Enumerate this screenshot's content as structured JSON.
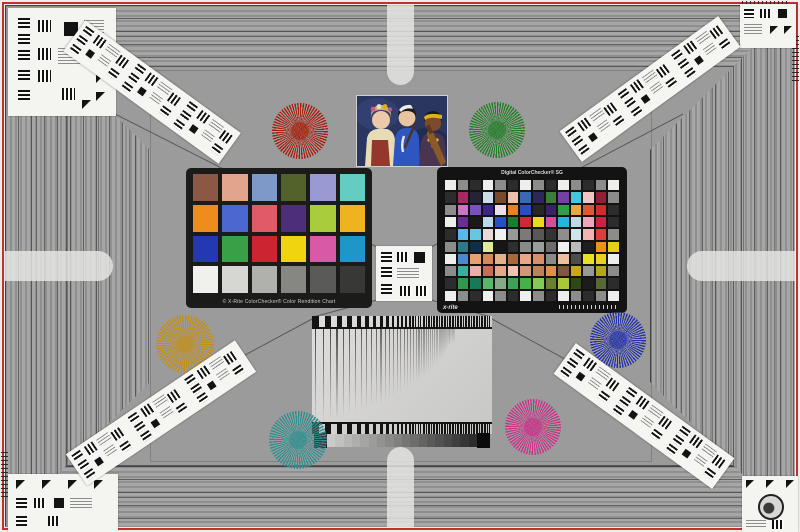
{
  "scene": {
    "base_gray": "#9b9b9b",
    "border_red": "#c23030",
    "edge_white": "#ededea",
    "pill_color": "rgba(230,230,228,0.82)",
    "diag_line": "#5a5a5a"
  },
  "colorchecker24": {
    "label": "© X-Rite ColorChecker® Color Rendition Chart",
    "frame": "#1b1b19",
    "rows": [
      [
        "#8a5843",
        "#e2a58c",
        "#7e99c8",
        "#52622a",
        "#9a9ad2",
        "#64ccc0"
      ],
      [
        "#ef8c1e",
        "#4a68d0",
        "#e05a68",
        "#4c2e7a",
        "#a8cc3c",
        "#eeb31e"
      ],
      [
        "#2438b4",
        "#3aa048",
        "#cc2430",
        "#f0d410",
        "#d85aa6",
        "#1e96c8"
      ],
      [
        "#f0f0ec",
        "#d6d6d2",
        "#b0b0ac",
        "#868682",
        "#5a5a58",
        "#383836"
      ]
    ]
  },
  "colorchecker_sg": {
    "title": "Digital ColorChecker® SG",
    "brand": "x-rite",
    "frame": "#131313",
    "grid": [
      [
        "#eeeeec",
        "#8c8c8a",
        "#2c2c2c",
        "#eeeeec",
        "#8c8c8a",
        "#2c2c2c",
        "#eeeeec",
        "#8c8c8a",
        "#2c2c2c",
        "#eeeeec",
        "#8c8c8a",
        "#2c2c2c",
        "#8c8c8a",
        "#eeeeec"
      ],
      [
        "#2c2c2c",
        "#a82862",
        "#242436",
        "#ccdce8",
        "#7a4a2c",
        "#eec0aa",
        "#3a68b2",
        "#2e2858",
        "#3e7c3c",
        "#7242a2",
        "#42c8da",
        "#f2c6c0",
        "#8e2136",
        "#8c8c8a"
      ],
      [
        "#8c8c8a",
        "#c878c2",
        "#7a52bc",
        "#3a2486",
        "#ecdfe8",
        "#e8821c",
        "#2a4ec2",
        "#262626",
        "#3a2268",
        "#2f9e44",
        "#e8a83c",
        "#e2582e",
        "#d42a2a",
        "#2c2c2c"
      ],
      [
        "#eeeeec",
        "#6a2c96",
        "#1a1a1a",
        "#bcd8ec",
        "#2450c8",
        "#1e7a2e",
        "#cc2a36",
        "#ecd822",
        "#d44e9c",
        "#28b4dc",
        "#c2d8e6",
        "#f0a4bc",
        "#cc2440",
        "#2c2c2c"
      ],
      [
        "#2c2c2c",
        "#58b8e8",
        "#66c8e0",
        "#e8d8d8",
        "#f0f0ec",
        "#989896",
        "#7a7a78",
        "#585856",
        "#343434",
        "#8e8e8c",
        "#cfe4ea",
        "#f0b4b4",
        "#e03c3c",
        "#8c8c8a"
      ],
      [
        "#8c8c8a",
        "#2a7a8c",
        "#0e3048",
        "#dfe89c",
        "#161616",
        "#2e2e2e",
        "#8a8a88",
        "#9c9c9a",
        "#6c6c6a",
        "#f0f0ee",
        "#bababa",
        "#1e1e1e",
        "#f09018",
        "#e8d018"
      ],
      [
        "#eeeeec",
        "#4a88d2",
        "#e8a070",
        "#d88858",
        "#e8b088",
        "#a86838",
        "#e8a888",
        "#d89068",
        "#8a8a88",
        "#eec0a0",
        "#4c4c4a",
        "#e8e020",
        "#e8d020",
        "#eeeeec"
      ],
      [
        "#8c8c8a",
        "#38b0a0",
        "#e8b0a8",
        "#d06858",
        "#e8a888",
        "#f0c0b0",
        "#d09878",
        "#c08058",
        "#e09048",
        "#805838",
        "#c8a818",
        "#989896",
        "#b0a818",
        "#8c8c8a"
      ],
      [
        "#2c2c2c",
        "#309848",
        "#187858",
        "#58b868",
        "#88a888",
        "#40a058",
        "#48b048",
        "#88c858",
        "#688030",
        "#a8c838",
        "#304818",
        "#1c1c1c",
        "#586838",
        "#2c2c2c"
      ],
      [
        "#eeeeec",
        "#8c8c8a",
        "#2c2c2c",
        "#eeeeec",
        "#8c8c8a",
        "#2c2c2c",
        "#eeeeec",
        "#8c8c8a",
        "#2c2c2c",
        "#eeeeec",
        "#8c8c8a",
        "#2c2c2c",
        "#8c8c8a",
        "#eeeeec"
      ]
    ]
  },
  "starbursts": [
    {
      "name": "red",
      "color": "#a81e0c",
      "cx": 300,
      "cy": 131,
      "d": 56
    },
    {
      "name": "green",
      "color": "#1e7e22",
      "cx": 497,
      "cy": 130,
      "d": 56
    },
    {
      "name": "gold",
      "color": "#c28e18",
      "cx": 185,
      "cy": 344,
      "d": 58
    },
    {
      "name": "navy",
      "color": "#2231a8",
      "cx": 618,
      "cy": 340,
      "d": 56
    },
    {
      "name": "teal",
      "color": "#2a8f8e",
      "cx": 298,
      "cy": 440,
      "d": 58
    },
    {
      "name": "magenta",
      "color": "#cc2e8a",
      "cx": 533,
      "cy": 427,
      "d": 56
    }
  ],
  "resolution_strips": [
    {
      "name": "top-left",
      "cx": 152,
      "cy": 92,
      "angle": 36,
      "len": 192
    },
    {
      "name": "top-right",
      "cx": 650,
      "cy": 89,
      "angle": -36,
      "len": 196
    },
    {
      "name": "bottom-left",
      "cx": 161,
      "cy": 413,
      "angle": -34,
      "len": 204
    },
    {
      "name": "bottom-right",
      "cx": 644,
      "cy": 416,
      "angle": 36,
      "len": 196
    }
  ],
  "sweep": {
    "bar_color": "#141414",
    "step_count": 18,
    "step_light_rgb": [
      202,
      202,
      200
    ],
    "step_dark_rgb": [
      44,
      44,
      44
    ]
  }
}
